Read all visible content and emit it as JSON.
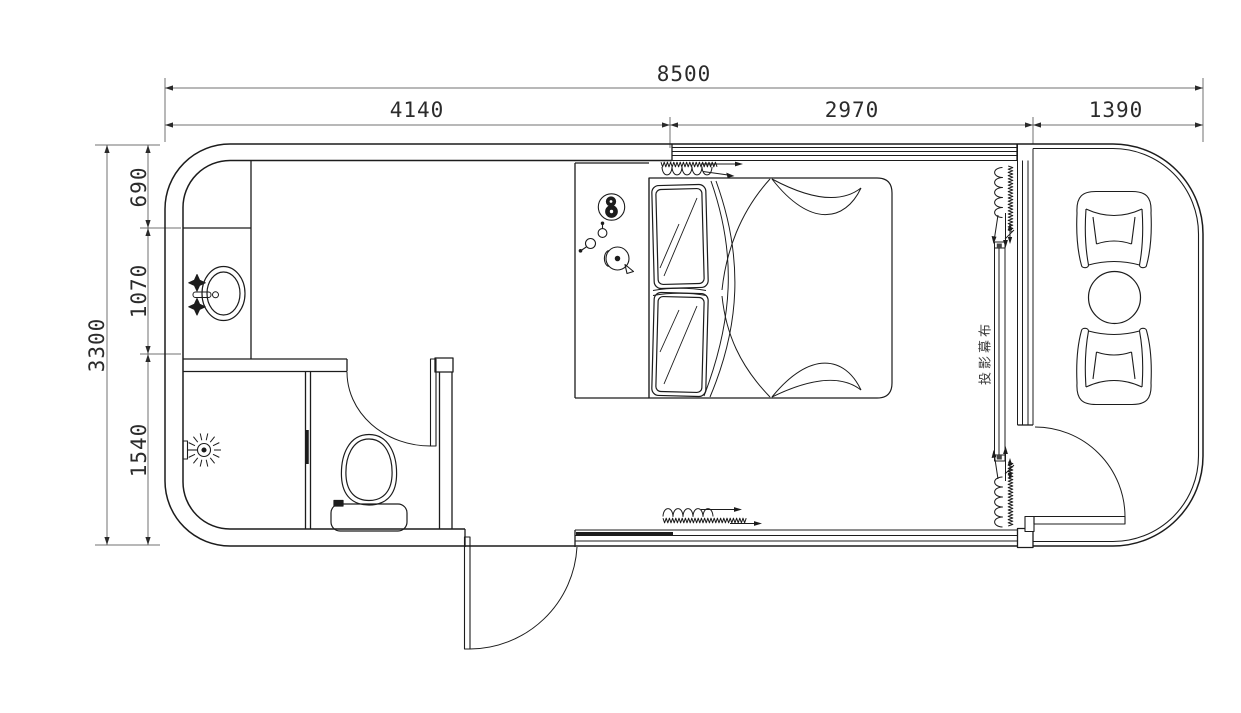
{
  "canvas": {
    "width": 1241,
    "height": 713
  },
  "colors": {
    "background": "#ffffff",
    "wall_line": "#1c1c1c",
    "dimension_line": "#707070",
    "text": "#2b2b2b"
  },
  "dimensions": {
    "top": {
      "total": "8500",
      "segments": [
        "4140",
        "2970",
        "1390"
      ]
    },
    "left": {
      "total": "3300",
      "segments": [
        "690",
        "1070",
        "1540"
      ]
    }
  },
  "labels": {
    "projection_screen": "投影幕布"
  },
  "fixtures": [
    "double-bed",
    "pillows",
    "bedside-kettle-set",
    "wash-basin",
    "faucet-handles",
    "shower-head",
    "toilet",
    "partition-wall",
    "entry-swing-door",
    "bathroom-swing-door",
    "balcony-swing-door",
    "sliding-window-bands",
    "curtain-track-symbols",
    "projection-screen",
    "armchairs",
    "round-tea-table"
  ]
}
